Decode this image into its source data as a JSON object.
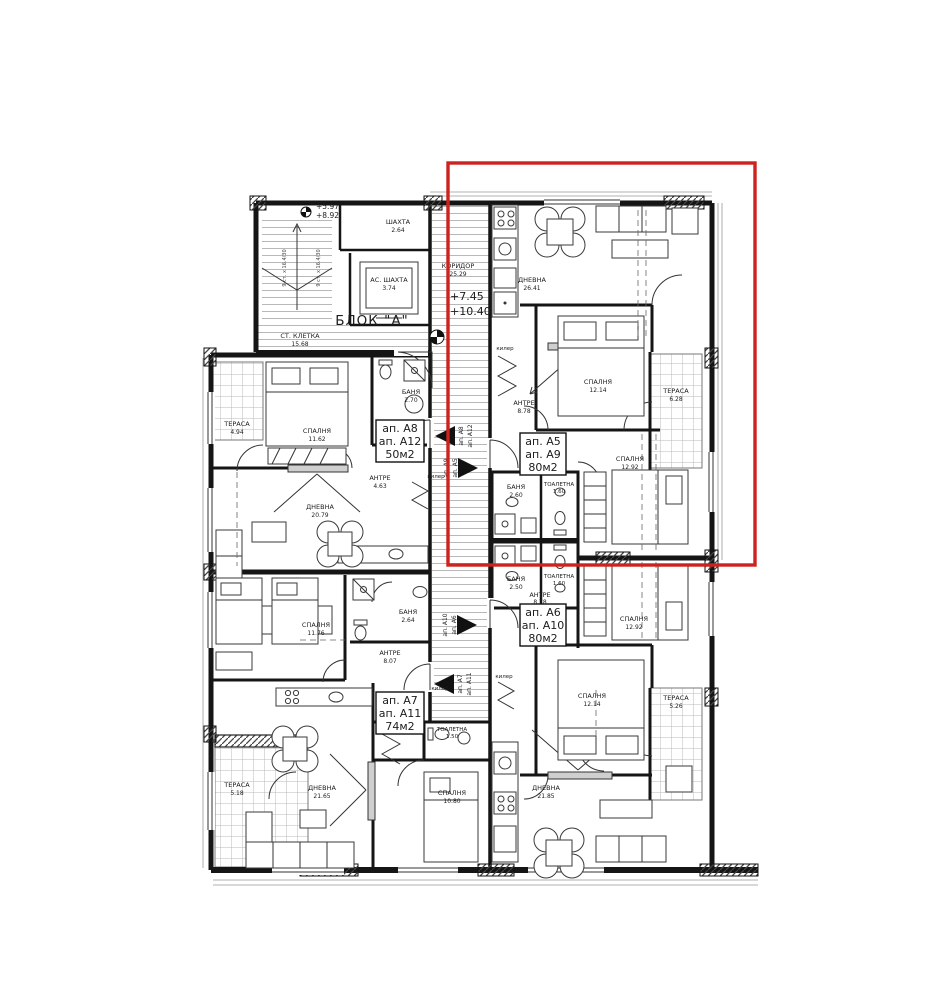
{
  "drawing": {
    "block_label": "БЛОК \"А\"",
    "core": {
      "shaft": {
        "label": "ШАХТА",
        "area": "2.64"
      },
      "lift": {
        "label": "АС. ШАХТА",
        "area": "3.74"
      },
      "stairwell": {
        "label": "СТ. КЛЕТКА",
        "area": "15.68",
        "steps_note": "9 ст. x 16.4/30"
      },
      "corridor": {
        "label": "КОРИДОР",
        "area": "25.29"
      },
      "kiler_label": "килер"
    },
    "elevations": {
      "stair_low": "+5.97",
      "stair_high": "+8.92",
      "corridor_low": "+7.45",
      "corridor_high": "+10.40"
    },
    "highlight_color": "#cc231e"
  },
  "apartments": {
    "a5": {
      "line1": "ап. А5",
      "line2": "ап. А9",
      "line3": "80м2"
    },
    "a6": {
      "line1": "ап. А6",
      "line2": "ап. А10",
      "line3": "80м2"
    },
    "a7": {
      "line1": "ап. А7",
      "line2": "ап. А11",
      "line3": "74м2"
    },
    "a8": {
      "line1": "ап. А8",
      "line2": "ап. А12",
      "line3": "50м2"
    }
  },
  "rooms": {
    "liv_a5": {
      "label": "ДНЕВНА",
      "area": "26.41"
    },
    "bed1_a5": {
      "label": "СПАЛНЯ",
      "area": "12.14"
    },
    "bed2_a5": {
      "label": "СПАЛНЯ",
      "area": "12.92"
    },
    "antre_a5": {
      "label": "АНТРЕ",
      "area": "8.78"
    },
    "bath_a5": {
      "label": "БАНЯ",
      "area": "2.60"
    },
    "wc_a5": {
      "label": "ТОАЛЕТНА",
      "area": "1.60"
    },
    "ter_a5": {
      "label": "ТЕРАСА",
      "area": "6.28"
    },
    "liv_a6": {
      "label": "ДНЕВНА",
      "area": "21.85"
    },
    "bed1_a6": {
      "label": "СПАЛНЯ",
      "area": "12.14"
    },
    "bed2_a6": {
      "label": "СПАЛНЯ",
      "area": "12.92"
    },
    "antre_a6": {
      "label": "АНТРЕ",
      "area": "8.78"
    },
    "bath_a6": {
      "label": "БАНЯ",
      "area": "2.50"
    },
    "wc_a6": {
      "label": "ТОАЛЕТНА",
      "area": "1.60"
    },
    "ter_a6": {
      "label": "ТЕРАСА",
      "area": "5.26"
    },
    "bed_a8": {
      "label": "СПАЛНЯ",
      "area": "11.62"
    },
    "bath_a8": {
      "label": "БАНЯ",
      "area": "2.70"
    },
    "antre_a8": {
      "label": "АНТРЕ",
      "area": "4.63"
    },
    "liv_a8": {
      "label": "ДНЕВНА",
      "area": "20.79"
    },
    "ter_a8": {
      "label": "ТЕРАСА",
      "area": "4.94"
    },
    "bed1_a7": {
      "label": "СПАЛНЯ",
      "area": "11.76"
    },
    "bath_a7": {
      "label": "БАНЯ",
      "area": "2.64"
    },
    "antre_a7": {
      "label": "АНТРЕ",
      "area": "8.07"
    },
    "liv_a7": {
      "label": "ДНЕВНА",
      "area": "21.65"
    },
    "bed2_a7": {
      "label": "СПАЛНЯ",
      "area": "10.80"
    },
    "wc_a7": {
      "label": "ТОАЛЕТНА",
      "area": "1.50"
    },
    "ter_a7": {
      "label": "ТЕРАСА",
      "area": "5.18"
    }
  },
  "entry_arrows": {
    "a8": {
      "line1": "ап. А8",
      "line2": "ап. А12"
    },
    "a5": {
      "line1": "ап. А9",
      "line2": "ап. А5"
    },
    "a6": {
      "line1": "ап. А10",
      "line2": "ап. А6"
    },
    "a7": {
      "line1": "ап. А7",
      "line2": "ап. А11"
    }
  }
}
